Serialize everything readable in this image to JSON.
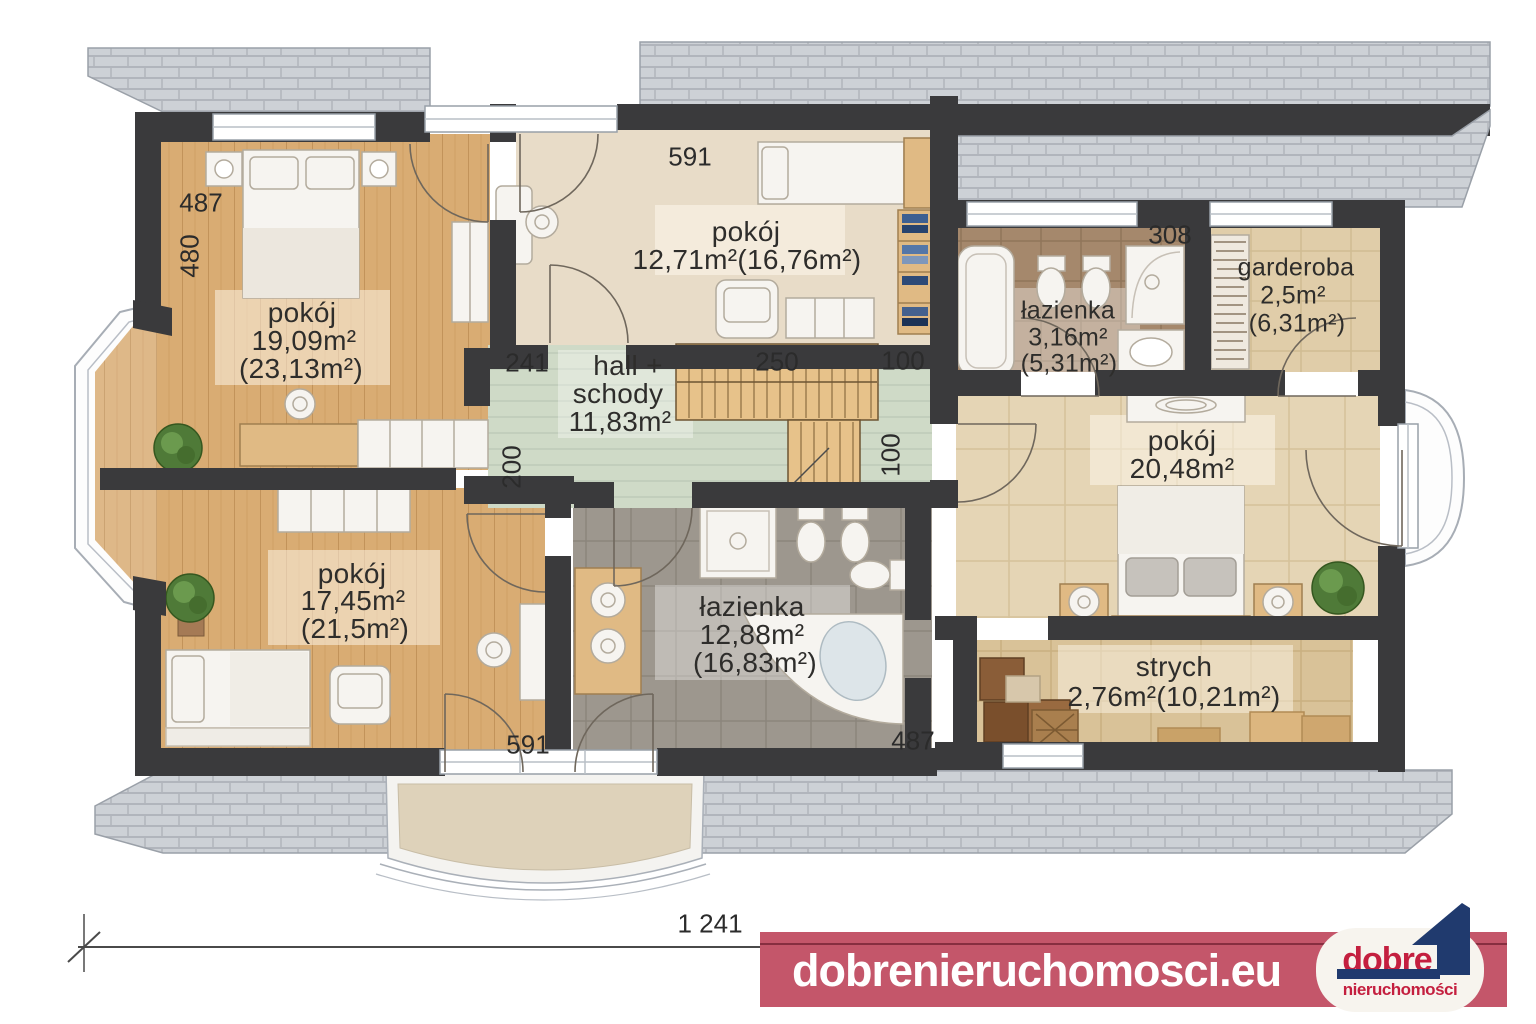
{
  "plan": {
    "rooms": {
      "room_top_left": {
        "name": "pokój",
        "area": "19,09m²",
        "area_total": "(23,13m²)"
      },
      "room_top_middle": {
        "name": "pokój",
        "area": "12,71m²(16,76m²)"
      },
      "hall": {
        "name_line1": "hall +",
        "name_line2": "schody",
        "area": "11,83m²"
      },
      "bathroom_top": {
        "name": "łazienka",
        "area": "3,16m²",
        "area_total": "(5,31m²)"
      },
      "wardrobe_room": {
        "name": "garderoba",
        "area": "2,5m²",
        "area_total": "(6,31m²)"
      },
      "room_right": {
        "name": "pokój",
        "area": "20,48m²"
      },
      "room_bottom_left": {
        "name": "pokój",
        "area": "17,45m²",
        "area_total": "(21,5m²)"
      },
      "bathroom_bottom": {
        "name": "łazienka",
        "area": "12,88m²",
        "area_total": "(16,83m²)"
      },
      "attic": {
        "name": "strych",
        "area": "2,76m²(10,21m²)"
      }
    },
    "dimensions": {
      "room_top_left_width": "487",
      "room_top_left_height": "480",
      "room_top_middle_width": "591",
      "hall_left_width": "241",
      "stairs_width": "250",
      "corridor_width_top": "100",
      "corridor_width_right": "100",
      "hall_depth": "200",
      "bathroom_top_width": "308",
      "room_bottom_left_width": "591",
      "bathroom_bottom_width": "487",
      "building_total_width": "1 241"
    }
  },
  "footer": {
    "website": "dobrenieruchomosci.eu",
    "logo_title": "dobre",
    "logo_subtitle": "nieruchomości"
  },
  "colors": {
    "wall": "#3a3a3c",
    "banner": "#c4566a",
    "logo_red": "#c41f3f",
    "logo_navy": "#203a6e"
  }
}
